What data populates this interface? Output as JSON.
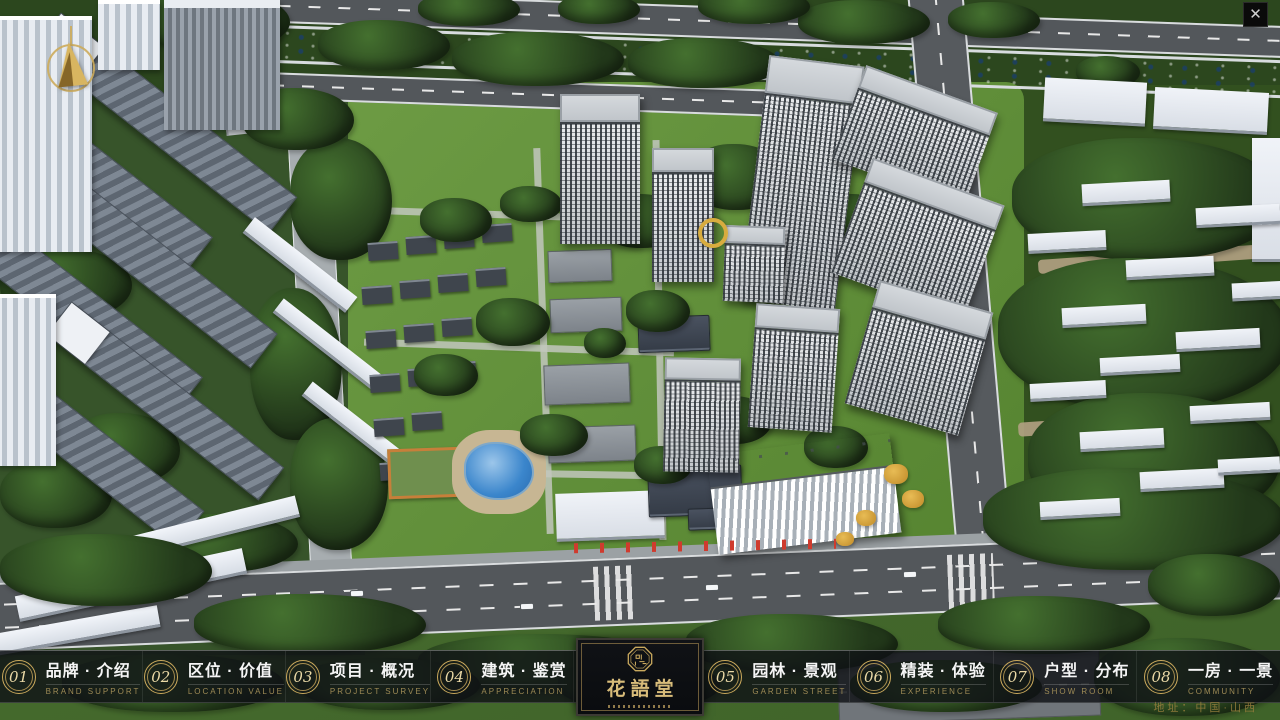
{
  "nav": {
    "items": [
      {
        "num": "01",
        "zh": "品牌 · 介绍",
        "en": "BRAND SUPPORT"
      },
      {
        "num": "02",
        "zh": "区位 · 价值",
        "en": "LOCATION VALUE"
      },
      {
        "num": "03",
        "zh": "项目 · 概况",
        "en": "PROJECT SURVEY"
      },
      {
        "num": "04",
        "zh": "建筑 · 鉴赏",
        "en": "APPRECIATION"
      },
      {
        "num": "05",
        "zh": "园林 · 景观",
        "en": "GARDEN STREET"
      },
      {
        "num": "06",
        "zh": "精装 · 体验",
        "en": "EXPERIENCE"
      },
      {
        "num": "07",
        "zh": "户型 · 分布",
        "en": "SHOW ROOM"
      },
      {
        "num": "08",
        "zh": "一房 · 一景",
        "en": "COMMUNITY"
      }
    ],
    "logo": {
      "title": "花語堂"
    },
    "address": "地址：中国·山西"
  },
  "window": {
    "close_glyph": "✕"
  },
  "colors": {
    "gold": "#c2a45e",
    "nav_bg": "rgba(16,18,22,0.82)",
    "zh_text": "#f5f5f5",
    "en_text": "#9d8a55"
  }
}
